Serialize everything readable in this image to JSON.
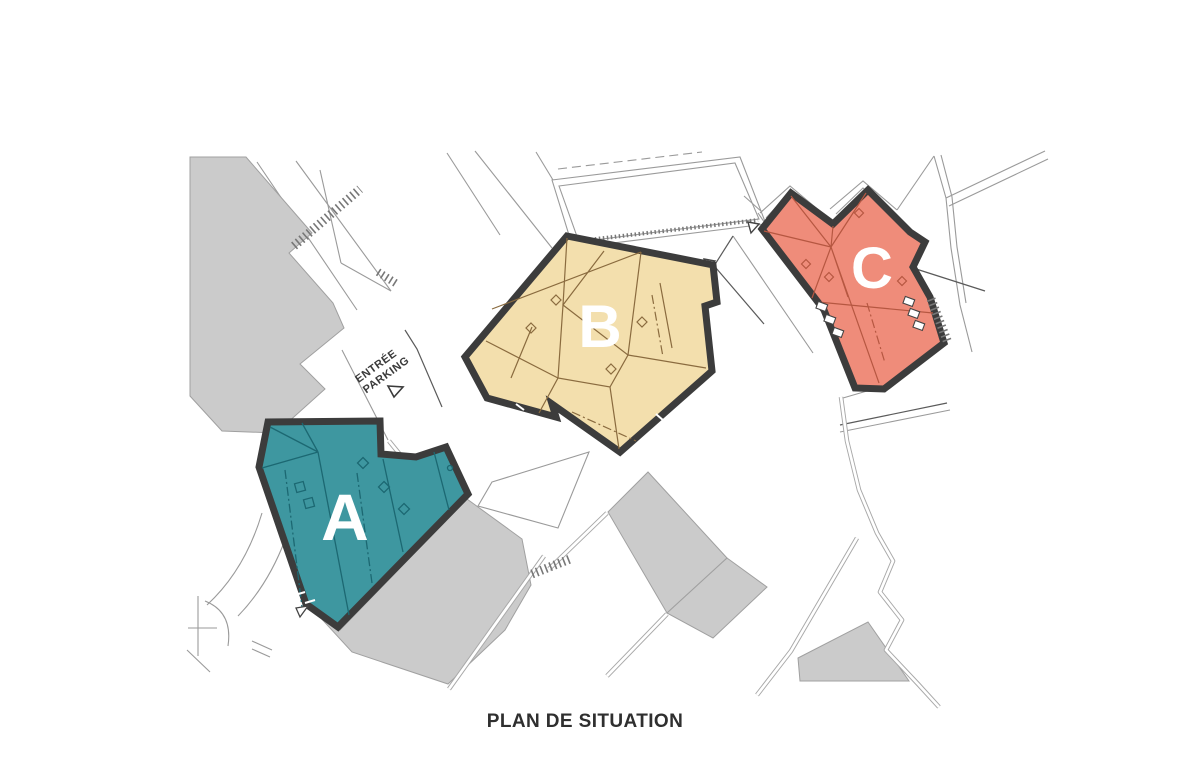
{
  "page": {
    "title": "PLAN DE SITUATION",
    "background": "#FFFFFF"
  },
  "plan": {
    "buildings": {
      "a": {
        "label": "A",
        "fill": "#3E97A0",
        "roofline": "#1C6872"
      },
      "b": {
        "label": "B",
        "fill": "#F3DFAD",
        "roofline": "#8A6B3F"
      },
      "c": {
        "label": "C",
        "fill": "#EF8C7A",
        "roofline": "#B65741"
      }
    },
    "entrance": {
      "line1": "ENTRÉE",
      "line2": "PARKING"
    },
    "colors": {
      "building_outline": "#3C3C3C",
      "context_building_fill": "#CBCBCB",
      "context_building_stroke": "#A0A0A0",
      "context_line": "#9A9A9A",
      "label_text": "#FFFFFF",
      "annotation_text": "#3A3A3A",
      "title_text": "#2F2F2F"
    }
  }
}
